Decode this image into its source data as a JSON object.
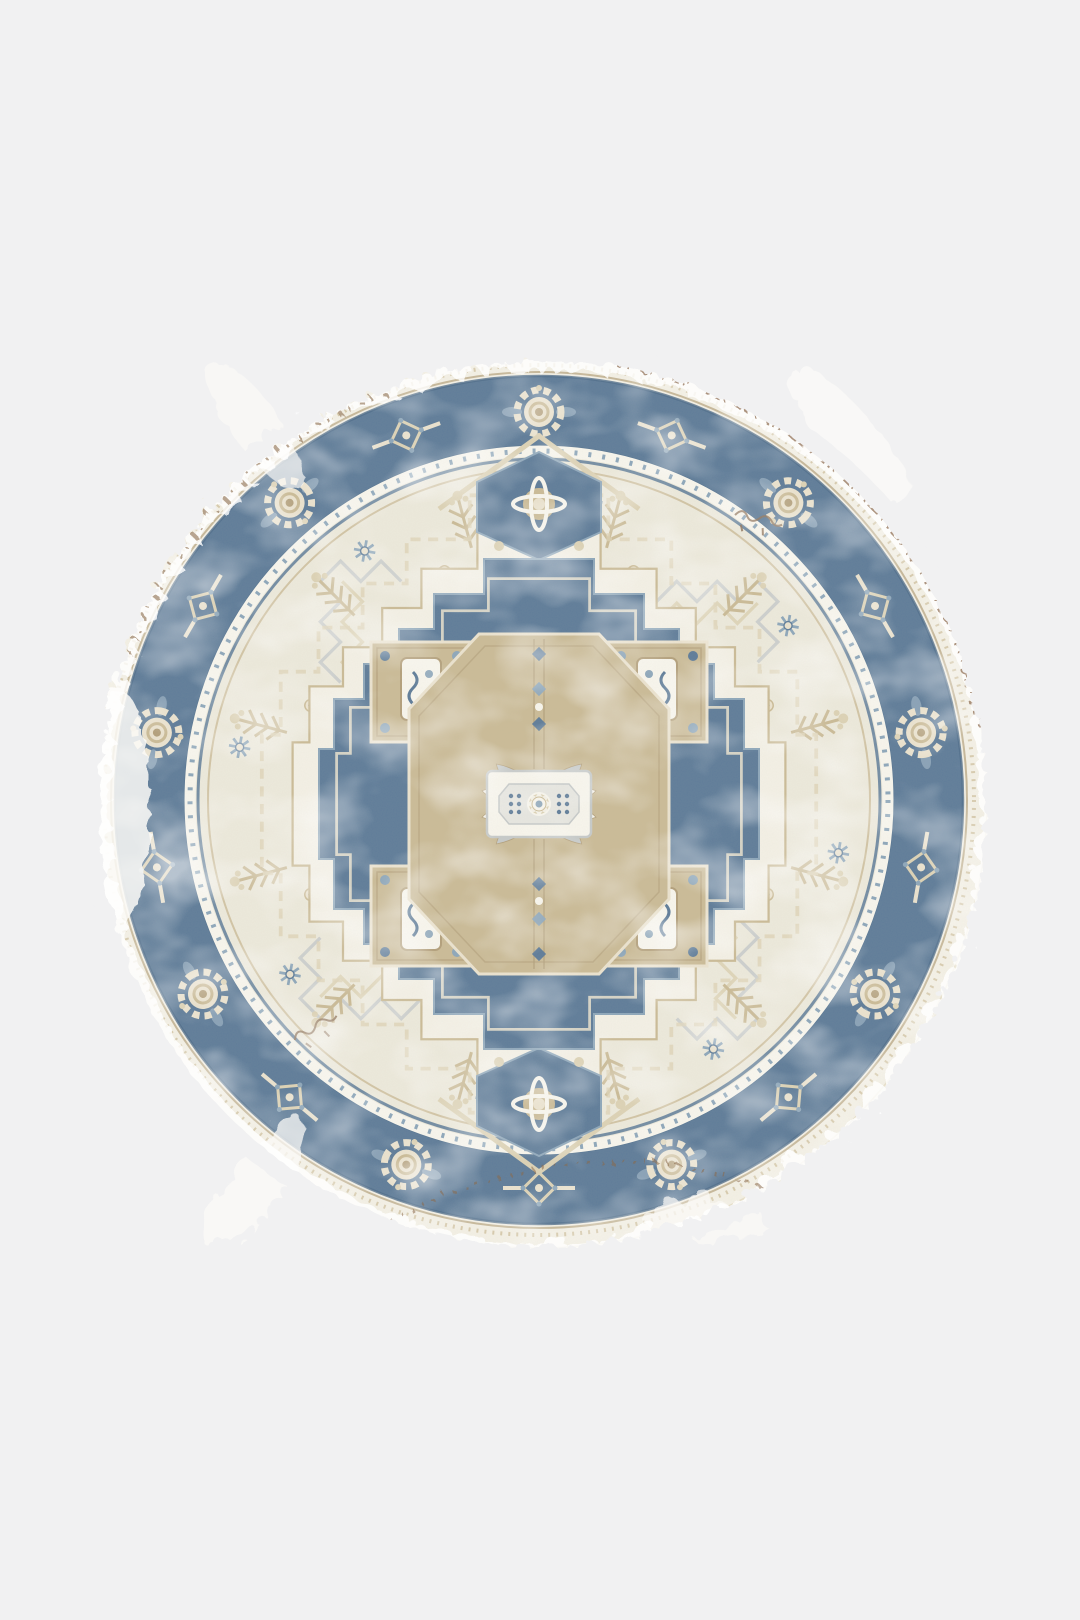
{
  "page": {
    "background": "#f1f1f2"
  },
  "rug": {
    "alt": "Round vintage-style Heriz medallion area rug in ivory, denim blue and tan with distressed faded edges",
    "shape": "circle",
    "center_x": 539,
    "center_y": 800,
    "radius": 452,
    "palette": {
      "edge_ivory": "#f4f0e5",
      "ivory": "#ece8da",
      "cream": "#e9e0ca",
      "white": "#f8f6ee",
      "blue": "#47698c",
      "blue_dark": "#35587c",
      "blue_light": "#7d9ab3",
      "tan": "#c4b28a",
      "tan_light": "#d9cdad",
      "tan_dark": "#a8926a",
      "gray": "#bfc3c5",
      "brown": "#8a6a4c",
      "brown_dark": "#7b5a3e"
    },
    "border": {
      "band_outer_r": 424,
      "band_inner_r": 352,
      "rosette_count": 18
    },
    "field": {
      "tree_count": 12,
      "spray_count": 8,
      "star_count": 8,
      "lattice_count": 4
    },
    "medallion": {
      "corner_squares": 4,
      "pendants": 2
    },
    "rings": [
      {
        "container": "border-motifs",
        "symbol": "sym-rosette",
        "alternate": "sym-xmotif",
        "count": 18,
        "radius": 388,
        "offset": 0,
        "scale": 1
      },
      {
        "container": "field-lattices",
        "symbol": "sym-lattice",
        "count": 4,
        "radius": 252,
        "offset": 45,
        "scale": 1.1
      },
      {
        "container": "field-outer-motifs",
        "symbol": "sym-tree",
        "count": 12,
        "radius": 287,
        "offset": 15,
        "scale": 1
      },
      {
        "container": "field-inner-motifs",
        "symbol": "sym-spray",
        "count": 8,
        "radius": 235,
        "offset": 22.5,
        "scale": 1
      },
      {
        "container": "field-stars",
        "symbol": "sym-star",
        "count": 8,
        "radius": 304,
        "offset": 10,
        "scale": 0.9
      }
    ]
  }
}
